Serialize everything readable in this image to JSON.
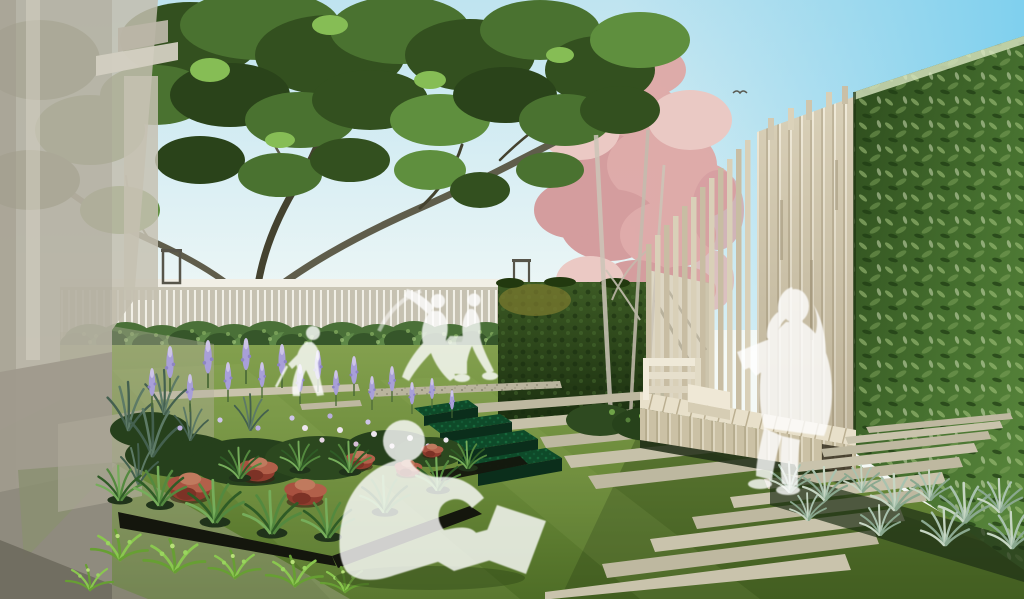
{
  "image": {
    "kind": "architectural-rendering",
    "subject": "courtyard garden perspective with study spaces",
    "width_px": 1024,
    "height_px": 599
  },
  "palette": {
    "sky_top": "#8ad2ec",
    "sky_soft": "#c9e7f1",
    "sky_horizon": "#f4f9f6",
    "canopy_dark": "#33501f",
    "canopy_mid": "#4a7230",
    "canopy_light": "#86bd55",
    "branch": "#5f5d4b",
    "maple_pink": "#dfa9a7",
    "maple_pink_light": "#ecc8c3",
    "maple_trunk": "#ccc5b8",
    "fence_rail": "#f1efe6",
    "fence_slat": "#c6c1b1",
    "lantern_frame": "#57554a",
    "hedge_row_green": "#4a7038",
    "hedge_panel_dark": "#2a4419",
    "hedge_panel_olive": "#7d7b2f",
    "cream_wall": "#ddd6c3",
    "timber_slat": "#d9d0b8",
    "timber_gap": "#f0ead9",
    "timber_shadow": "#ab9f83",
    "bench_wood": "#e8e0ca",
    "bench_front": "#cdc3a9",
    "green_wall_dark": "#2c4a1c",
    "green_wall_mid": "#4c7433",
    "green_wall_light": "#a8c77f",
    "lawn_light": "#7d9c4a",
    "lawn_dark": "#4e6d26",
    "paver": "#c9c3ac",
    "gravel": "#b9b49d",
    "step_planting_emerald": "#0e4a29",
    "planter_dark": "#14160d",
    "flower_purple": "#a89fd8",
    "flower_purple_light": "#cdc4e8",
    "red_foliage": "#a85140",
    "foliage_green": "#54893f",
    "silver_grass": "#9fb9a4",
    "building_beige": "#b5b0a1",
    "building_gray": "#8d897c",
    "silhouette": "#ffffff"
  },
  "scene": {
    "sky": {
      "top_color": "#8ad2ec",
      "horizon_color": "#f4f9f6",
      "bird_count": 1
    },
    "left_building": {
      "label": "translucent building corner with cornice and planters",
      "opacity": 0.9
    },
    "big_tree": {
      "label": "spreading dark-green canopy tree",
      "trunk_in": "flower bed"
    },
    "maple_tree": {
      "label": "pink japanese maple",
      "trunk_count": 3
    },
    "fence": {
      "label": "white vertical-slat fence",
      "lantern_count": 2
    },
    "hedge_row": {
      "label": "clipped shrub row in front of fence",
      "shrub_count": 13
    },
    "hedge_panel": {
      "label": "dark green hedge wall panel"
    },
    "timber_screen": {
      "label": "stepped vertical timber slat screen",
      "stepped_slat_count": 12
    },
    "green_wall": {
      "label": "tall leafy green wall on right"
    },
    "bench": {
      "label": "long timber bench with backrest end"
    },
    "steps": {
      "label": "stone treads with emerald planted risers",
      "stone_strip_count": 5,
      "planted_riser_count": 4
    },
    "paver_ladder": {
      "label": "stepping paver strips in lawn",
      "strip_count": 10
    },
    "flower_bed": {
      "label": "perennial bed with purple salvia, red foliage, grasses and ferns"
    },
    "silver_grasses": {
      "label": "silvery grass tufts at green wall base",
      "tuft_count": 11
    },
    "figures": [
      {
        "name": "person-sitting-on-grass-with-laptop"
      },
      {
        "name": "person-reading-on-bench"
      },
      {
        "name": "person-standing-left"
      },
      {
        "name": "person-walking-center"
      },
      {
        "name": "person-at-small-table"
      }
    ],
    "props": [
      {
        "name": "small-white-table"
      },
      {
        "name": "open-laptop"
      },
      {
        "name": "open-book"
      }
    ]
  }
}
